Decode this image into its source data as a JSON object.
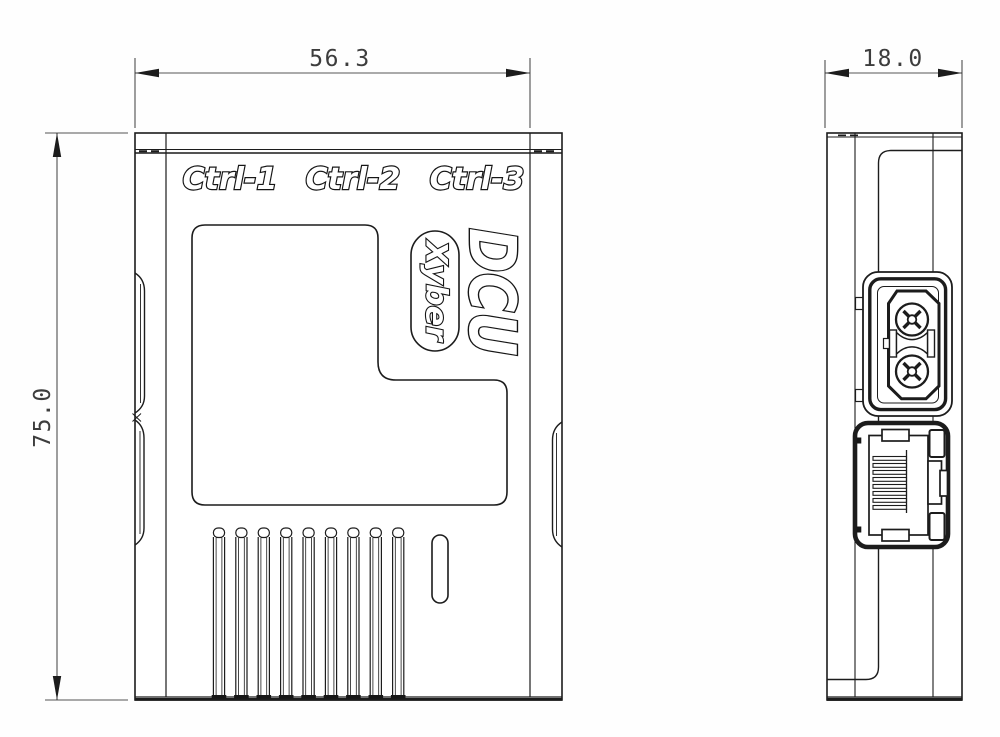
{
  "front_view": {
    "port_labels": [
      "Ctrl-1",
      "Ctrl-2",
      "Ctrl-3"
    ],
    "product_name": "DCU",
    "brand": "Xyber",
    "width_dim": "56.3",
    "height_dim": "75.0"
  },
  "side_view": {
    "width_dim": "18.0"
  },
  "style": {
    "line_color": "#1c1c1c",
    "dim_text_color": "#3d3d3d",
    "label_fill": "#ffffff",
    "background": "#fefefe"
  }
}
